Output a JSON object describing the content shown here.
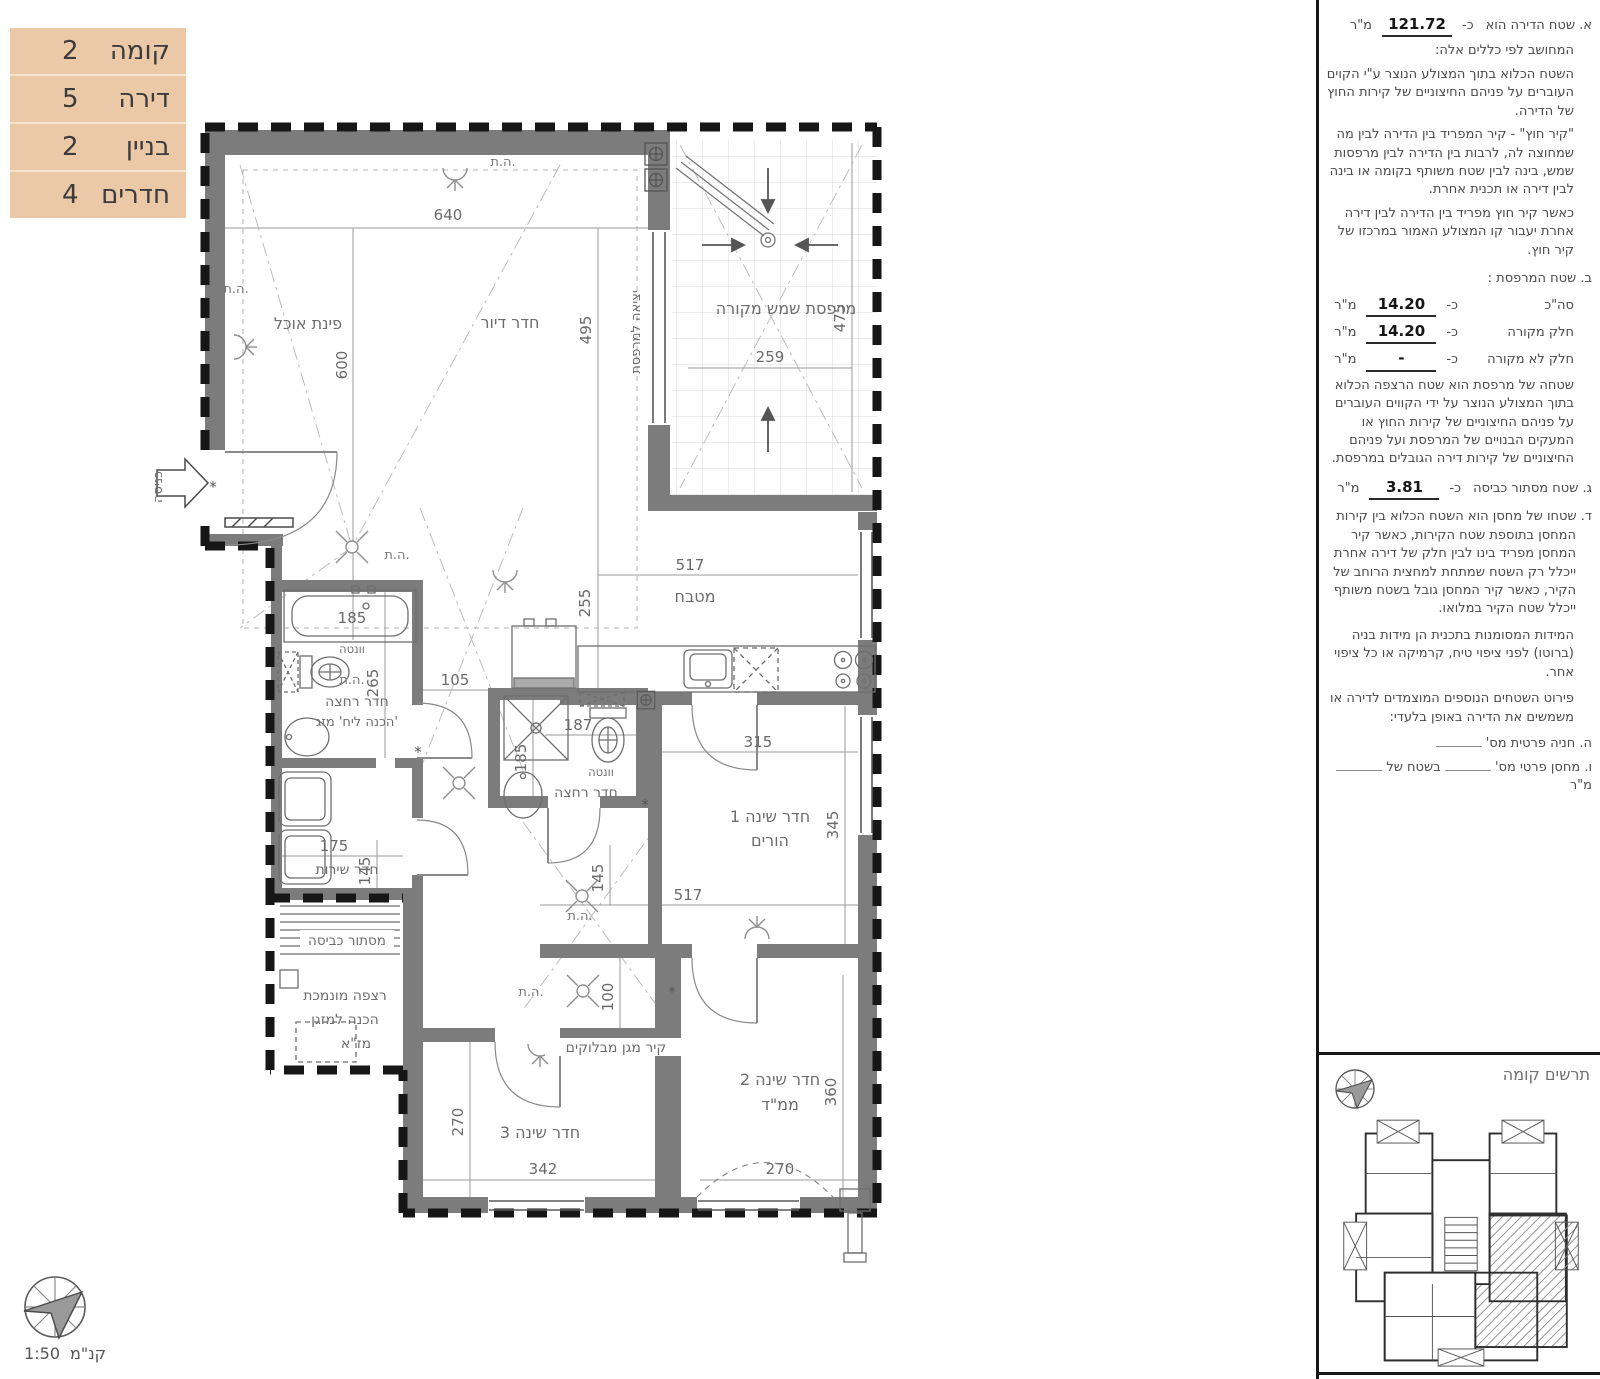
{
  "info_table": {
    "rows": [
      {
        "label": "קומה",
        "value": "2"
      },
      {
        "label": "דירה",
        "value": "5"
      },
      {
        "label": "בניין",
        "value": "2"
      },
      {
        "label": "חדרים",
        "value": "4"
      }
    ]
  },
  "plan": {
    "labels": {
      "dining": "פינת אוכל",
      "living": "חדר דיור",
      "balcony": "מרפסת שמש מקורה",
      "exit_balcony": "יציאה למרפסת",
      "entrance": "כניסה",
      "kitchen": "מטבח",
      "bath": "חדר רחצה",
      "bath_note": "הכנה ליח' מזג'",
      "vent": "וונטה",
      "bed1_a": "חדר שינה 1",
      "bed1_b": "הורים",
      "service": "חדר שירות",
      "laundry": "מסתור כביסה",
      "lowered_a": "רצפה מונמכת",
      "lowered_b": "הכנה למזגן",
      "lowered_c": "מז\"א",
      "block_wall": "קיר מגן מבלוקים",
      "bed3": "חדר שינה 3",
      "bed2_a": "חדר שינה 2",
      "bed2_b": "ממ\"ד",
      "ht": "ה.ת.",
      "asterisk": "*"
    },
    "dims": {
      "a640": "640",
      "a600": "600",
      "a495": "495",
      "a475": "475",
      "a259": "259",
      "a517": "517",
      "a255": "255",
      "a105": "105",
      "a265": "265",
      "a185": "185",
      "a187": "187",
      "b185": "185",
      "a315": "315",
      "a345": "345",
      "a175": "175",
      "a145": "145",
      "b517": "517",
      "b145": "145",
      "a100": "100",
      "a270": "270",
      "a342": "342",
      "b270": "270",
      "a360": "360"
    }
  },
  "notes": {
    "a_label": "א. שטח הדירה הוא",
    "approx": "כ-",
    "a_value": "121.72",
    "unit": "מ\"ר",
    "a_sub": "המחושב לפי כללים אלה:",
    "a_p1": "השטח הכלוא בתוך המצולע הנוצר ע\"י הקוים העוברים על פניהם החיצוניים של קירות החוץ של הדירה.",
    "a_p2": "\"קיר חוץ\" - קיר המפריד בין הדירה לבין מה שמחוצה לה, לרבות בין הדירה לבין מרפסות שמש, בינה לבין שטח משותף בקומה או בינה לבין דירה או תכנית אחרת.",
    "a_p3": "כאשר קיר חוץ מפריד בין הדירה לבין דירה אחרת יעבור קו המצולע האמור במרכזו של קיר חוץ.",
    "b_title": "ב. שטח המרפסת :",
    "b_rows": [
      {
        "label": "סה\"כ",
        "value": "14.20"
      },
      {
        "label": "חלק מקורה",
        "value": "14.20"
      },
      {
        "label": "חלק לא מקורה",
        "value": "-"
      }
    ],
    "b_p": "שטחה של מרפסת הוא שטח הרצפה הכלוא בתוך המצולע הנוצר על ידי הקווים העוברים על פניהם החיצוניים של קירות החוץ או המעקים הבנויים של המרפסת ועל פניהם החיצוניים של קירות דירה הגובלים במרפסת.",
    "c_label": "ג. שטח מסתור כביסה",
    "c_value": "3.81",
    "d_p": "ד. שטחו של מחסן הוא השטח הכלוא בין קירות המחסן בתוספת שטח הקירות, כאשר קיר המחסן מפריד בינו לבין חלק של דירה אחרת ייכלל רק השטח שמתחת למחצית הרוחב של הקיר, כאשר קיר המחסן גובל בשטח משותף ייכלל שטח הקיר במלואו.",
    "e_p": "המידות המסומנות בתכנית הן מידות בניה (ברוטו) לפני ציפוי טיח, קרמיקה או כל ציפוי אחר.",
    "f_p": "פירוט השטחים הנוספים המוצמדים לדירה או  משמשים את הדירה באופן בלעדי:",
    "g_label": "ה. חניה פרטית מס'",
    "h_label1": "ו. מחסן פרטי מס'",
    "h_label2": "בשטח של"
  },
  "keyplan": {
    "title": "תרשים קומה"
  },
  "scale": {
    "label": "קנ\"מ",
    "value": "1:50"
  }
}
